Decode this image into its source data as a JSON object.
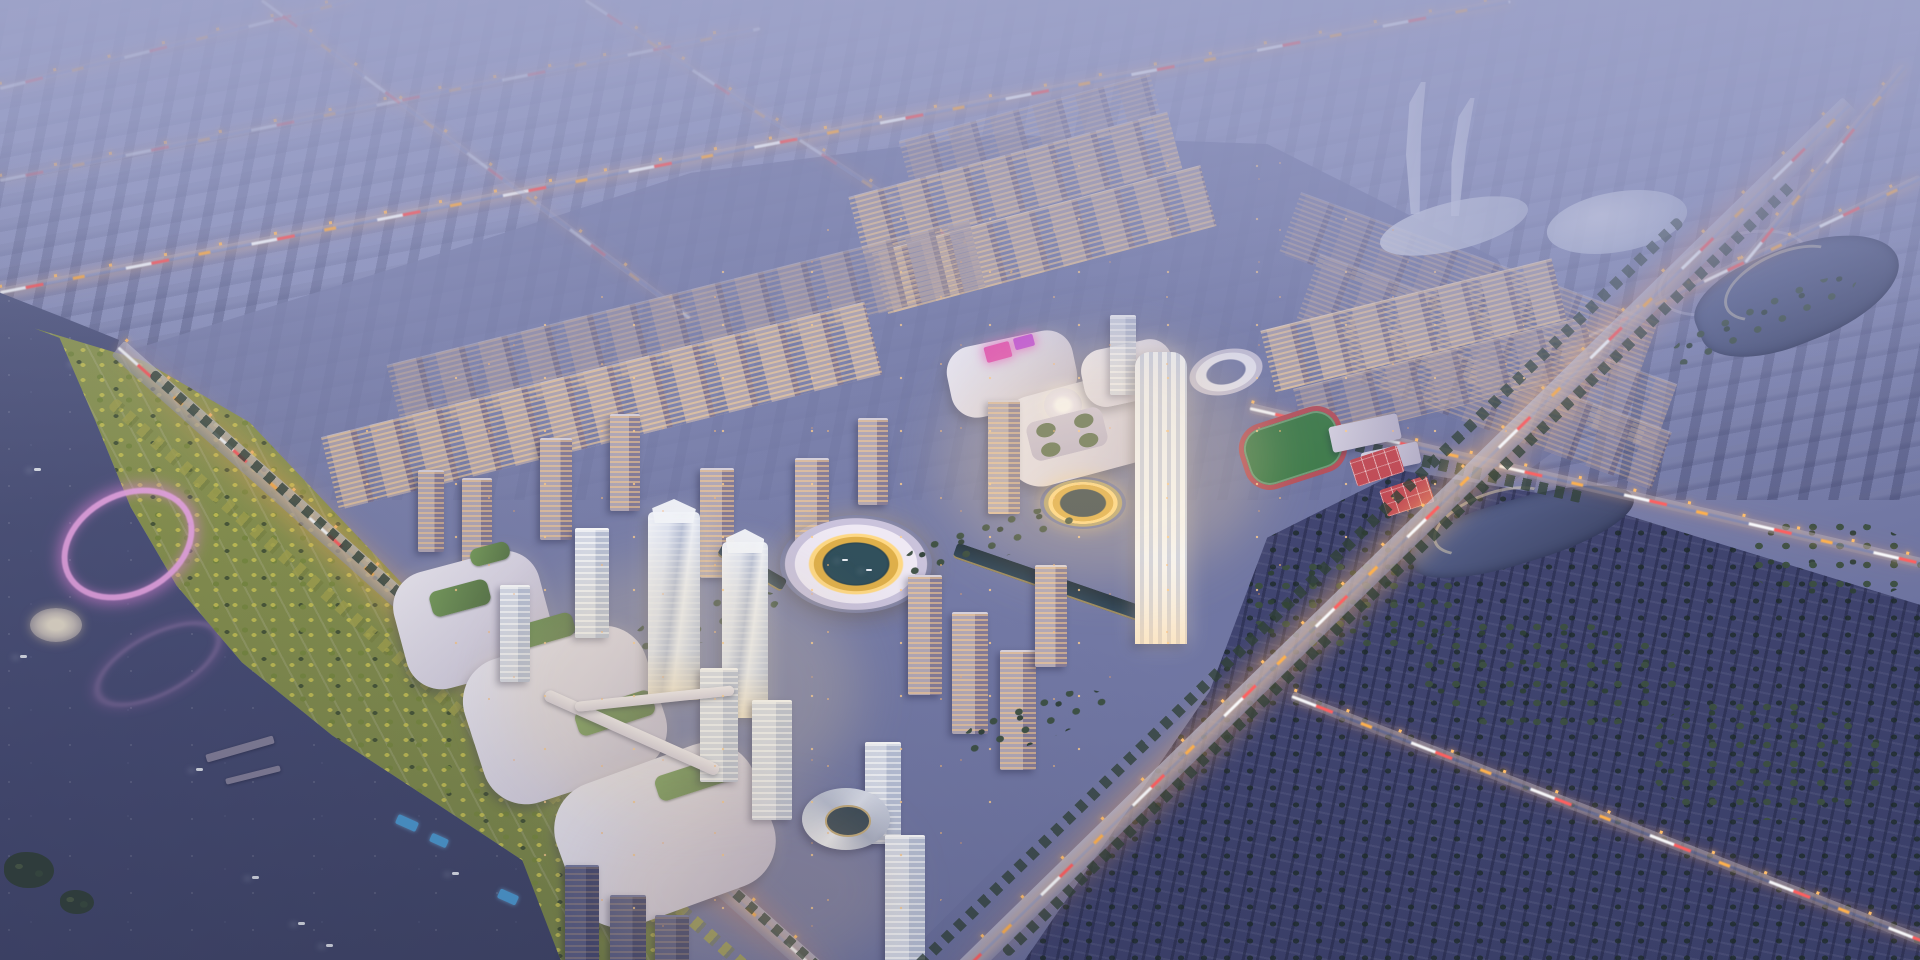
{
  "scene": {
    "description": "High-oblique aerial architectural rendering of a riverside new-town master plan at dusk, with a glowing mixed-use core, ring-shaped stadium over water, golden circular pond plaza, lit residential blocks, hazy distant city, lake and autumn waterfront park on the west, and dark forest district across the main arterial road",
    "time_of_day": "dusk",
    "view": "aerial"
  },
  "palette": {
    "sky-top": "#9BA1C7",
    "sky-mid": "#8087B1",
    "sky-low": "#6A709D",
    "water-deep": "#3A4165",
    "water-mid": "#4A5078",
    "water-light": "#5D6389",
    "park-yellow": "#9AA355",
    "forest-base": "#4B5080",
    "window-warm": "#FFCE8E",
    "lamp": "#FFBE6C",
    "trail-red": "#FF5F5F",
    "trail-amber": "#FFB14D",
    "gold": "#E0B04A",
    "gold-bright": "#FFD985",
    "canal": "#31475A",
    "track-green": "#3E7B49",
    "track-red": "#B5505A",
    "court-red": "#C24B55",
    "pink-glow": "#F3ACEC",
    "screen-pink": "#E857B2",
    "screen-violet": "#C754D6"
  }
}
